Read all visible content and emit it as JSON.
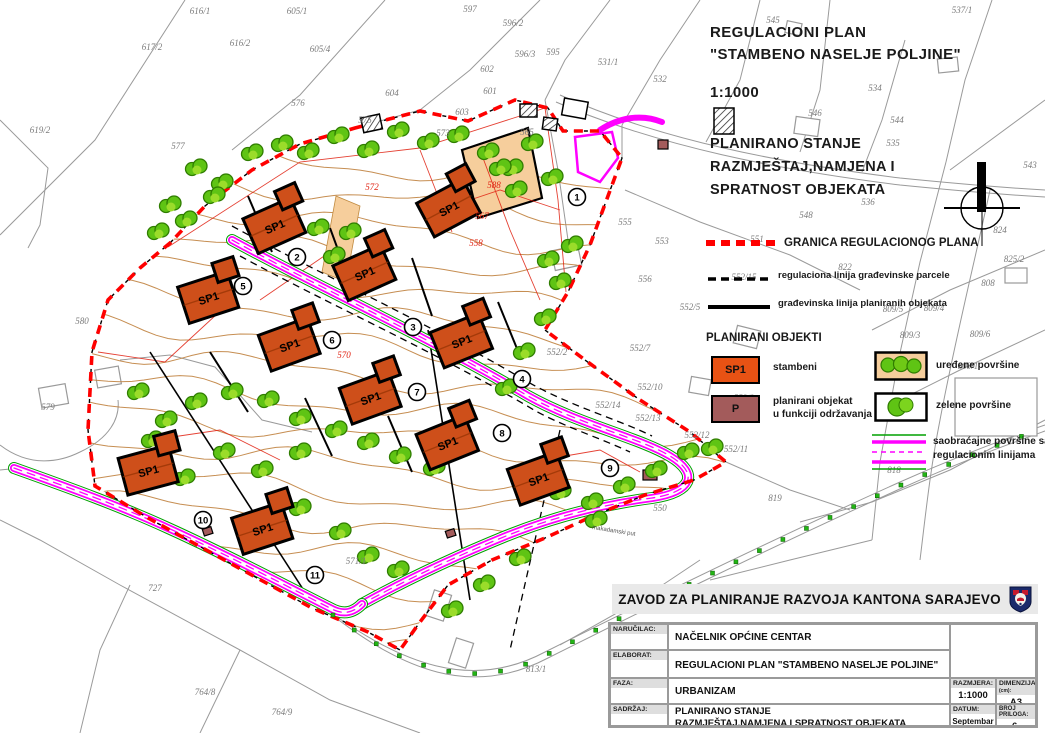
{
  "title_block": {
    "line1": "REGULACIONI  PLAN",
    "line2": "\"STAMBENO NASELJE POLJINE\"",
    "scale": "1:1000",
    "subtitle1": "PLANIRANO STANJE",
    "subtitle2": "RAZMJEŠTAJ,NAMJENA I",
    "subtitle3": "SPRATNOST OBJEKATA"
  },
  "legend": {
    "boundary_label": "GRANICA REGULACIONOG PLANA",
    "reg_line_label": "regulaciona linija građevinske parcele",
    "build_line_label": "građevinska linija planiranih objekata",
    "objects_header": "PLANIRANI OBJEKTI",
    "sp1_symbol": "SP1",
    "sp1_label": "stambeni",
    "p_symbol": "P",
    "p_label1": "planirani objekat",
    "p_label2": "u funkciji održavanja",
    "arranged_label": "uređene površine",
    "green_label": "zelene površine",
    "roads_label1": "saobraćajne površine sa",
    "roads_label2": "regulacionim linijama"
  },
  "colors": {
    "boundary": "#FF0000",
    "road": "#FF00FF",
    "road_green": "#00A000",
    "house": "#CE4F1A",
    "house_legend": "#E85214",
    "maintenance": "#A35B5B",
    "contour": "#C0823F",
    "tree": "#5FC414",
    "tree_dark": "#2F7D00",
    "tree_light": "#9BDC2A",
    "arranged": "#F6CE9C",
    "cadastral": "#8C8C8C",
    "red_line": "#E02010"
  },
  "map": {
    "house_label": "SP1",
    "road_label": "makadamski put",
    "houses": [
      {
        "x": 278,
        "y": 224,
        "r": -24
      },
      {
        "x": 452,
        "y": 206,
        "r": -28
      },
      {
        "x": 368,
        "y": 271,
        "r": -24
      },
      {
        "x": 212,
        "y": 296,
        "r": -18
      },
      {
        "x": 293,
        "y": 343,
        "r": -20
      },
      {
        "x": 465,
        "y": 339,
        "r": -22
      },
      {
        "x": 374,
        "y": 396,
        "r": -20
      },
      {
        "x": 451,
        "y": 441,
        "r": -22
      },
      {
        "x": 152,
        "y": 469,
        "r": -15
      },
      {
        "x": 542,
        "y": 477,
        "r": -20
      },
      {
        "x": 266,
        "y": 527,
        "r": -18
      }
    ],
    "markers": [
      {
        "n": "1",
        "x": 577,
        "y": 197
      },
      {
        "n": "2",
        "x": 297,
        "y": 257
      },
      {
        "n": "3",
        "x": 413,
        "y": 327
      },
      {
        "n": "4",
        "x": 522,
        "y": 379
      },
      {
        "n": "5",
        "x": 243,
        "y": 286
      },
      {
        "n": "6",
        "x": 332,
        "y": 340
      },
      {
        "n": "7",
        "x": 417,
        "y": 392
      },
      {
        "n": "8",
        "x": 502,
        "y": 433
      },
      {
        "n": "9",
        "x": 610,
        "y": 468
      },
      {
        "n": "10",
        "x": 203,
        "y": 520
      },
      {
        "n": "11",
        "x": 315,
        "y": 575
      }
    ],
    "parcel_labels": [
      {
        "t": "616/1",
        "x": 200,
        "y": 8
      },
      {
        "t": "605/1",
        "x": 297,
        "y": 8
      },
      {
        "t": "597",
        "x": 470,
        "y": 6
      },
      {
        "t": "596/2",
        "x": 513,
        "y": 20
      },
      {
        "t": "545",
        "x": 773,
        "y": 17
      },
      {
        "t": "537/1",
        "x": 962,
        "y": 7
      },
      {
        "t": "617/2",
        "x": 152,
        "y": 44
      },
      {
        "t": "616/2",
        "x": 240,
        "y": 40
      },
      {
        "t": "605/4",
        "x": 320,
        "y": 46
      },
      {
        "t": "596/3",
        "x": 525,
        "y": 51
      },
      {
        "t": "595",
        "x": 553,
        "y": 49
      },
      {
        "t": "531/1",
        "x": 608,
        "y": 59
      },
      {
        "t": "602",
        "x": 487,
        "y": 66
      },
      {
        "t": "532",
        "x": 660,
        "y": 76
      },
      {
        "t": "534",
        "x": 875,
        "y": 85
      },
      {
        "t": "601",
        "x": 490,
        "y": 88
      },
      {
        "t": "604",
        "x": 392,
        "y": 90
      },
      {
        "t": "576",
        "x": 298,
        "y": 100
      },
      {
        "t": "546",
        "x": 815,
        "y": 110
      },
      {
        "t": "544",
        "x": 897,
        "y": 117
      },
      {
        "t": "603",
        "x": 462,
        "y": 109
      },
      {
        "t": "575",
        "x": 365,
        "y": 117
      },
      {
        "t": "565",
        "x": 527,
        "y": 129
      },
      {
        "t": "573",
        "x": 443,
        "y": 130
      },
      {
        "t": "619/2",
        "x": 40,
        "y": 127
      },
      {
        "t": "577",
        "x": 178,
        "y": 143
      },
      {
        "t": "535",
        "x": 893,
        "y": 140
      },
      {
        "t": "543",
        "x": 1030,
        "y": 162
      },
      {
        "t": "536",
        "x": 868,
        "y": 199
      },
      {
        "t": "548",
        "x": 806,
        "y": 212
      },
      {
        "t": "555",
        "x": 625,
        "y": 219
      },
      {
        "t": "824",
        "x": 1000,
        "y": 227
      },
      {
        "t": "553",
        "x": 662,
        "y": 238
      },
      {
        "t": "551",
        "x": 757,
        "y": 236
      },
      {
        "t": "556",
        "x": 645,
        "y": 276
      },
      {
        "t": "552/15",
        "x": 744,
        "y": 274
      },
      {
        "t": "822",
        "x": 845,
        "y": 264
      },
      {
        "t": "825/2",
        "x": 1014,
        "y": 256
      },
      {
        "t": "808",
        "x": 988,
        "y": 280
      },
      {
        "t": "552/5",
        "x": 690,
        "y": 304
      },
      {
        "t": "809/5",
        "x": 893,
        "y": 306
      },
      {
        "t": "809/4",
        "x": 934,
        "y": 305
      },
      {
        "t": "580",
        "x": 82,
        "y": 318
      },
      {
        "t": "809/3",
        "x": 910,
        "y": 332
      },
      {
        "t": "809/6",
        "x": 980,
        "y": 331
      },
      {
        "t": "552/2",
        "x": 557,
        "y": 349
      },
      {
        "t": "552/7",
        "x": 640,
        "y": 345
      },
      {
        "t": "809/1",
        "x": 968,
        "y": 363
      },
      {
        "t": "552/10",
        "x": 650,
        "y": 384
      },
      {
        "t": "552/9",
        "x": 744,
        "y": 395
      },
      {
        "t": "579",
        "x": 48,
        "y": 404
      },
      {
        "t": "552/14",
        "x": 608,
        "y": 402
      },
      {
        "t": "552/13",
        "x": 648,
        "y": 415
      },
      {
        "t": "552/12",
        "x": 697,
        "y": 432
      },
      {
        "t": "552/11",
        "x": 736,
        "y": 446
      },
      {
        "t": "818",
        "x": 894,
        "y": 467
      },
      {
        "t": "819",
        "x": 775,
        "y": 495
      },
      {
        "t": "550",
        "x": 660,
        "y": 505
      },
      {
        "t": "571/1",
        "x": 356,
        "y": 558
      },
      {
        "t": "727",
        "x": 155,
        "y": 585
      },
      {
        "t": "813/1",
        "x": 536,
        "y": 666
      },
      {
        "t": "764/8",
        "x": 205,
        "y": 689
      },
      {
        "t": "764/9",
        "x": 282,
        "y": 709
      }
    ],
    "red_labels": [
      {
        "t": "572",
        "x": 372,
        "y": 184
      },
      {
        "t": "588",
        "x": 494,
        "y": 182
      },
      {
        "t": "567",
        "x": 482,
        "y": 213
      },
      {
        "t": "558",
        "x": 476,
        "y": 240
      },
      {
        "t": "570",
        "x": 344,
        "y": 352
      }
    ],
    "trees": [
      [
        196,
        168
      ],
      [
        222,
        183
      ],
      [
        252,
        153
      ],
      [
        282,
        144
      ],
      [
        308,
        152
      ],
      [
        338,
        136
      ],
      [
        368,
        150
      ],
      [
        398,
        131
      ],
      [
        428,
        142
      ],
      [
        458,
        135
      ],
      [
        488,
        152
      ],
      [
        512,
        168
      ],
      [
        532,
        143
      ],
      [
        552,
        178
      ],
      [
        170,
        205
      ],
      [
        158,
        232
      ],
      [
        186,
        220
      ],
      [
        214,
        196
      ],
      [
        318,
        228
      ],
      [
        334,
        256
      ],
      [
        350,
        232
      ],
      [
        500,
        168
      ],
      [
        516,
        190
      ],
      [
        548,
        260
      ],
      [
        572,
        245
      ],
      [
        560,
        282
      ],
      [
        545,
        318
      ],
      [
        524,
        352
      ],
      [
        506,
        388
      ],
      [
        138,
        392
      ],
      [
        166,
        420
      ],
      [
        196,
        402
      ],
      [
        232,
        392
      ],
      [
        268,
        400
      ],
      [
        300,
        418
      ],
      [
        336,
        430
      ],
      [
        368,
        442
      ],
      [
        400,
        456
      ],
      [
        434,
        468
      ],
      [
        300,
        452
      ],
      [
        262,
        470
      ],
      [
        224,
        452
      ],
      [
        184,
        478
      ],
      [
        152,
        440
      ],
      [
        340,
        532
      ],
      [
        368,
        556
      ],
      [
        300,
        508
      ],
      [
        398,
        570
      ],
      [
        560,
        492
      ],
      [
        592,
        502
      ],
      [
        624,
        486
      ],
      [
        656,
        470
      ],
      [
        688,
        452
      ],
      [
        596,
        520
      ],
      [
        520,
        558
      ],
      [
        484,
        584
      ],
      [
        452,
        610
      ],
      [
        712,
        448
      ]
    ]
  },
  "footer": {
    "org": "ZAVOD ZA PLANIRANJE RAZVOJA KANTONA SARAJEVO",
    "narucilac_label": "NARUČILAC:",
    "narucilac": "NAČELNIK OPĆINE CENTAR",
    "elaborat_label": "ELABORAT:",
    "elaborat": "REGULACIONI PLAN  \"STAMBENO NASELJE POLJINE\"",
    "faza_label": "FAZA:",
    "faza": "URBANIZAM",
    "sadrzaj_label": "SADRŽAJ:",
    "sadrzaj1": "PLANIRANO STANJE",
    "sadrzaj2": "RAZMJEŠTAJ,NAMJENA I SPRATNOST OBJEKATA",
    "razmjera_label": "RAZMJERA:",
    "razmjera": "1:1000",
    "dimenzija_label": "DIMENZIJA",
    "dimenzija_unit": "(cm):",
    "dimenzija": "A3",
    "datum_label": "DATUM:",
    "datum": "Septembar 2020.",
    "broj_label": "BROJ PRILOGA:",
    "broj": "6."
  }
}
